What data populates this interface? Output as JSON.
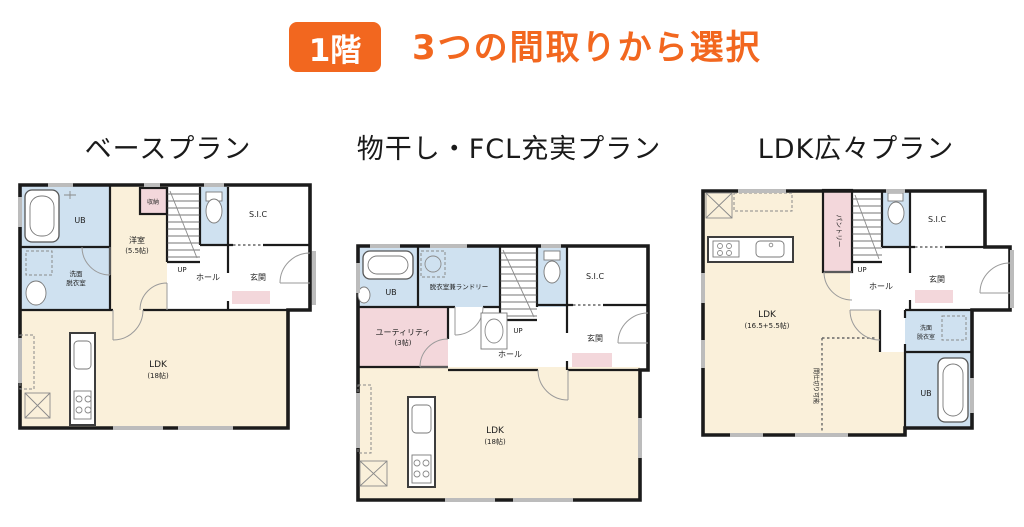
{
  "header": {
    "floor_badge": "1階",
    "title": "3つの間取りから選択"
  },
  "colors": {
    "accent": "#f2671f",
    "room_cream": "#faf0da",
    "room_blue": "#cfe1f0",
    "room_pink": "#f3d7db",
    "wall": "#1b1b1b",
    "window_gray": "#bcbcbc"
  },
  "plans": [
    {
      "title": "ベースプラン",
      "labels": {
        "ub": "UB",
        "washroom_l1": "洗面",
        "washroom_l2": "脱衣室",
        "bedroom": "洋室",
        "bedroom_size": "(5.5帖)",
        "closet": "収納",
        "up": "UP",
        "hall": "ホール",
        "entrance": "玄関",
        "sic": "S.I.C",
        "ldk": "LDK",
        "ldk_size": "(18帖)"
      }
    },
    {
      "title": "物干し・FCL充実プラン",
      "labels": {
        "ub": "UB",
        "laundry": "脱衣室兼ランドリー",
        "utility": "ユーティリティ",
        "utility_size": "(3帖)",
        "up": "UP",
        "hall": "ホール",
        "entrance": "玄関",
        "sic": "S.I.C",
        "ldk": "LDK",
        "ldk_size": "(18帖)"
      }
    },
    {
      "title": "LDK広々プラン",
      "labels": {
        "pantry": "パントリー",
        "up": "UP",
        "hall": "ホール",
        "entrance": "玄関",
        "sic": "S.I.C",
        "washroom_l1": "洗面",
        "washroom_l2": "脱衣室",
        "ub": "UB",
        "ldk": "LDK",
        "ldk_size": "(16.5+5.5帖)",
        "partition": "間仕切り可能"
      }
    }
  ]
}
